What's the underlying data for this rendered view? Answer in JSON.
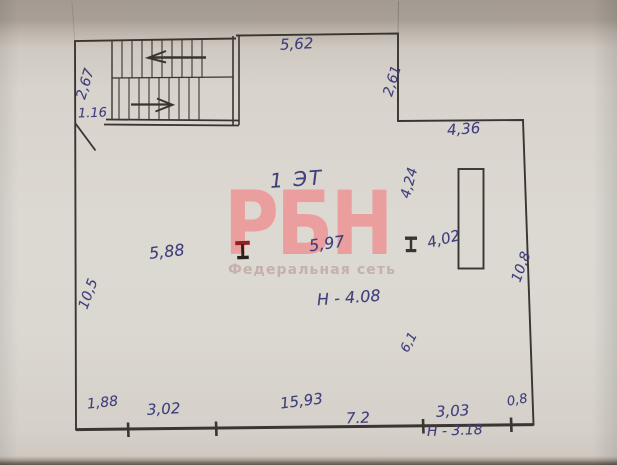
{
  "floor_plan": {
    "floor_label": "1 ЭТ",
    "watermark": {
      "brand": "РБН",
      "tagline": "Федеральная сеть"
    },
    "heights": {
      "hall": "Н - 4.08",
      "right_zone": "Н - 3.18"
    },
    "dimensions": {
      "stair_depth": "2,67",
      "stair_opening": "1.16",
      "top_wall": "5,62",
      "top_recess": "2,61",
      "upper_right_wall": "4,36",
      "left_wall": "10,5",
      "right_wall": "10,8",
      "column_span_left": "5,88",
      "column_span_right": "5,97",
      "shaft_vertical": "4,24",
      "shaft_length": "4,02",
      "inner_span": "6,1",
      "bottom_seg_1": "1,88",
      "bottom_seg_2": "3,02",
      "bottom_total": "15,93",
      "bottom_seg_3": "7.2",
      "bottom_seg_4": "3,03",
      "bottom_seg_5": "0,8"
    },
    "colors": {
      "ink": "#3a3530",
      "pen": "#3f3f7c",
      "watermark_brand": "#ec9a99",
      "watermark_tagline": "#c5aeab",
      "column_red": "#8e2220"
    }
  }
}
